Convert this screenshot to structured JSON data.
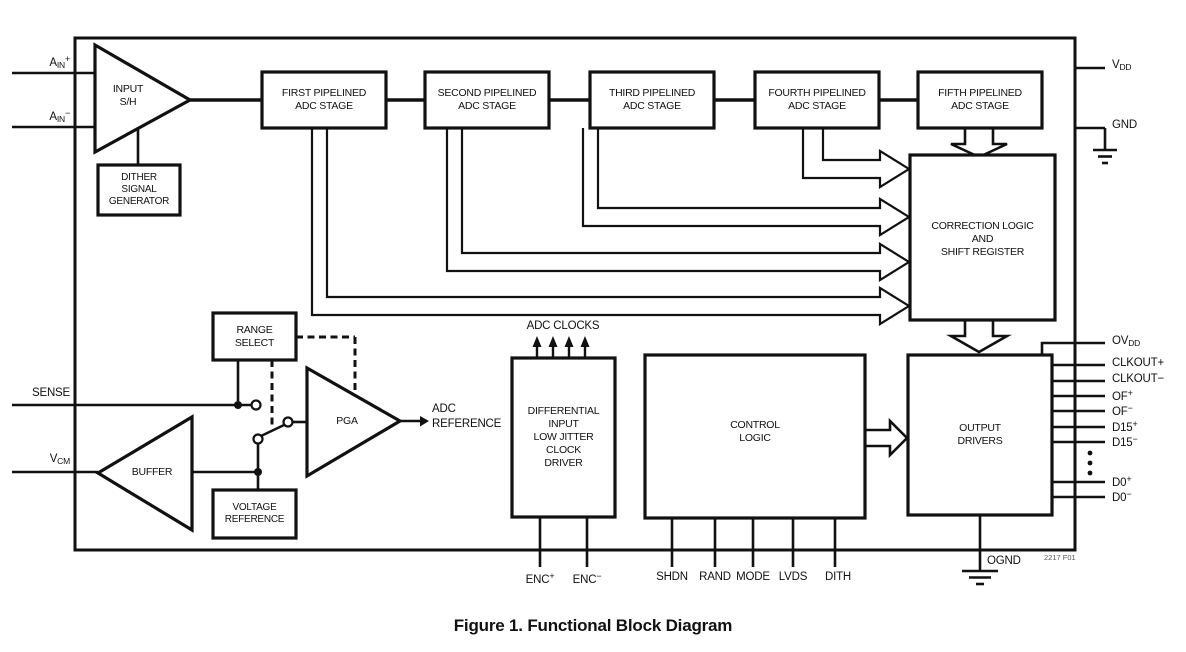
{
  "figure": {
    "caption": "Figure 1. Functional Block Diagram",
    "ref": "2217 F01"
  },
  "colors": {
    "line": "#111111",
    "background": "#ffffff"
  },
  "blocks": {
    "input_sh": {
      "lines": [
        "INPUT",
        "S/H"
      ]
    },
    "dither": {
      "lines": [
        "DITHER",
        "SIGNAL",
        "GENERATOR"
      ]
    },
    "stage1": {
      "lines": [
        "FIRST PIPELINED",
        "ADC STAGE"
      ]
    },
    "stage2": {
      "lines": [
        "SECOND PIPELINED",
        "ADC STAGE"
      ]
    },
    "stage3": {
      "lines": [
        "THIRD PIPELINED",
        "ADC STAGE"
      ]
    },
    "stage4": {
      "lines": [
        "FOURTH PIPELINED",
        "ADC STAGE"
      ]
    },
    "stage5": {
      "lines": [
        "FIFTH PIPELINED",
        "ADC STAGE"
      ]
    },
    "correction": {
      "lines": [
        "CORRECTION LOGIC",
        "AND",
        "SHIFT REGISTER"
      ]
    },
    "range_select": {
      "lines": [
        "RANGE",
        "SELECT"
      ]
    },
    "pga": {
      "lines": [
        "PGA"
      ]
    },
    "buffer": {
      "lines": [
        "BUFFER"
      ]
    },
    "voltage_reference": {
      "lines": [
        "VOLTAGE",
        "REFERENCE"
      ]
    },
    "clock_driver": {
      "lines": [
        "DIFFERENTIAL",
        "INPUT",
        "LOW JITTER",
        "CLOCK",
        "DRIVER"
      ]
    },
    "control_logic": {
      "lines": [
        "CONTROL",
        "LOGIC"
      ]
    },
    "output_drivers": {
      "lines": [
        "OUTPUT",
        "DRIVERS"
      ]
    }
  },
  "labels": {
    "adc_clocks": "ADC CLOCKS",
    "adc_reference": {
      "lines": [
        "ADC",
        "REFERENCE"
      ]
    }
  },
  "pins": {
    "ain_p": {
      "segments": [
        {
          "t": "A"
        },
        {
          "sub": "IN"
        },
        {
          "sup": "+"
        }
      ]
    },
    "ain_n": {
      "segments": [
        {
          "t": "A"
        },
        {
          "sub": "IN"
        },
        {
          "sup": "−"
        }
      ]
    },
    "sense": {
      "segments": [
        {
          "t": "SENSE"
        }
      ]
    },
    "vcm": {
      "segments": [
        {
          "t": "V"
        },
        {
          "sub": "CM"
        }
      ]
    },
    "vdd": {
      "segments": [
        {
          "t": "V"
        },
        {
          "sub": "DD"
        }
      ]
    },
    "gnd": {
      "segments": [
        {
          "t": "GND"
        }
      ]
    },
    "ovdd": {
      "segments": [
        {
          "t": "OV"
        },
        {
          "sub": "DD"
        }
      ]
    },
    "clkout_p": {
      "segments": [
        {
          "t": "CLKOUT+"
        }
      ]
    },
    "clkout_n": {
      "segments": [
        {
          "t": "CLKOUT−"
        }
      ]
    },
    "of_p": {
      "segments": [
        {
          "t": "OF"
        },
        {
          "sup": "+"
        }
      ]
    },
    "of_n": {
      "segments": [
        {
          "t": "OF"
        },
        {
          "sup": "−"
        }
      ]
    },
    "d15_p": {
      "segments": [
        {
          "t": "D15"
        },
        {
          "sup": "+"
        }
      ]
    },
    "d15_n": {
      "segments": [
        {
          "t": "D15"
        },
        {
          "sup": "−"
        }
      ]
    },
    "d0_p": {
      "segments": [
        {
          "t": "D0"
        },
        {
          "sup": "+"
        }
      ]
    },
    "d0_n": {
      "segments": [
        {
          "t": "D0"
        },
        {
          "sup": "−"
        }
      ]
    },
    "enc_p": {
      "segments": [
        {
          "t": "ENC"
        },
        {
          "sup": "+"
        }
      ]
    },
    "enc_n": {
      "segments": [
        {
          "t": "ENC"
        },
        {
          "sup": "−"
        }
      ]
    },
    "shdn": {
      "segments": [
        {
          "t": "SHDN"
        }
      ]
    },
    "rand": {
      "segments": [
        {
          "t": "RAND"
        }
      ]
    },
    "mode": {
      "segments": [
        {
          "t": "MODE"
        }
      ]
    },
    "lvds": {
      "segments": [
        {
          "t": "LVDS"
        }
      ]
    },
    "dith": {
      "segments": [
        {
          "t": "DITH"
        }
      ]
    },
    "ognd": {
      "segments": [
        {
          "t": "OGND"
        }
      ]
    }
  }
}
